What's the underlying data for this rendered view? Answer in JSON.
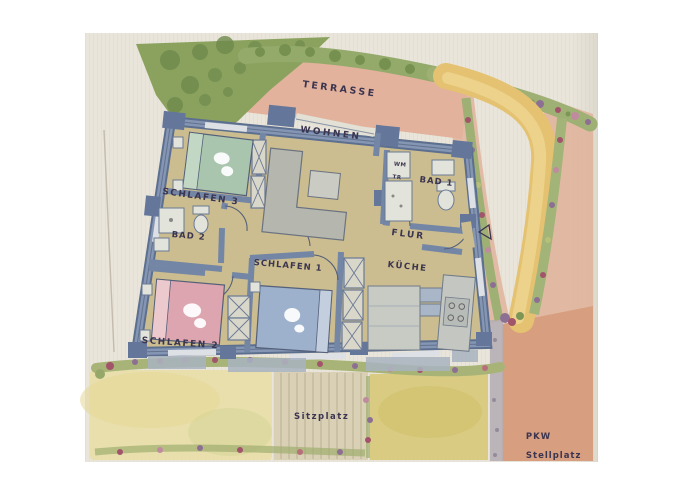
{
  "title": "Hand-painted watercolor floor plan with garden",
  "labels": {
    "terrasse": "TERRASSE",
    "wohnen": "WOHNEN",
    "schlafen3": "SCHLAFEN 3",
    "bad2": "BAD 2",
    "schlafen2": "SCHLAFEN 2",
    "schlafen1": "SCHLAFEN 1",
    "bad1": "BAD 1",
    "wm": "WM",
    "tr": "TR",
    "flur": "FLUR",
    "kueche": "KÜCHE",
    "sitzplatz": "Sitzplatz",
    "pkw": "PKW",
    "stellplatz": "Stellplatz"
  },
  "colors": {
    "paper": "#e9e5da",
    "ink": "#3b3550",
    "wall": "#7486a5",
    "floor": "#cbbd8f",
    "terrace": "#e2b29c",
    "hedge": "#8ba25f",
    "foliage": "#9fb074",
    "path_yellow": "#e4c271",
    "bed_green": "#a9c5ae",
    "bed_pink": "#dda5af",
    "bed_blue": "#9db1cc",
    "lawn_left": "#e8dfad",
    "lawn_right": "#d9cc82",
    "deck": "#d9d0b6",
    "parking": "#d89e80",
    "walkway_pink": "#e0b49c"
  }
}
